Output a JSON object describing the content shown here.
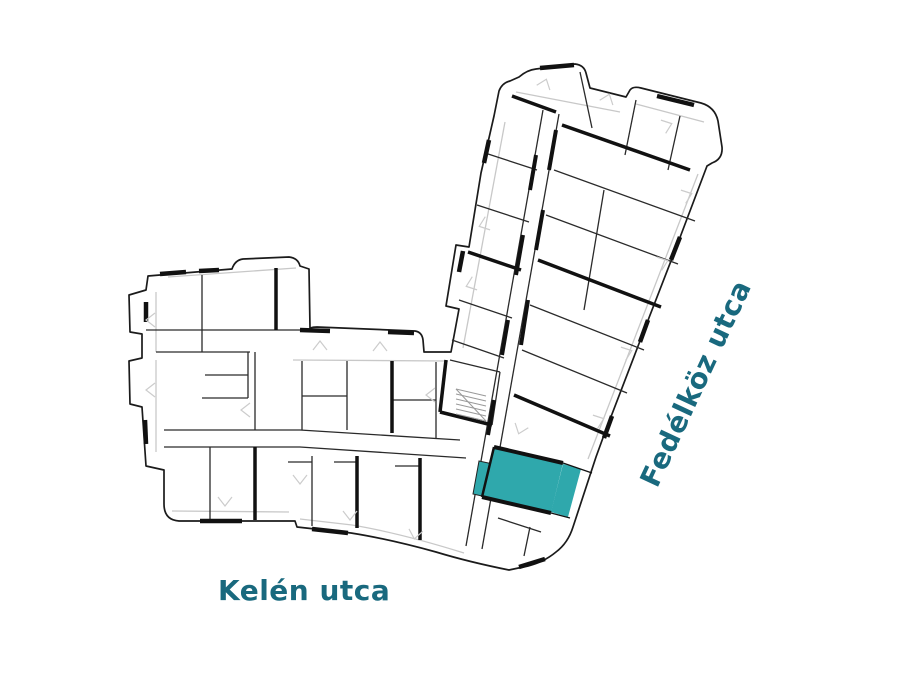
{
  "floor_plan": {
    "streets": {
      "bottom": "Kelén utca",
      "right": "Fedélköz utca"
    },
    "highlight_color": "#2fa8ac",
    "colors": {
      "street_label": "#19697e",
      "walls": "#1a1a1a",
      "light_lines": "#c8c8c8",
      "background": "#ffffff"
    }
  }
}
